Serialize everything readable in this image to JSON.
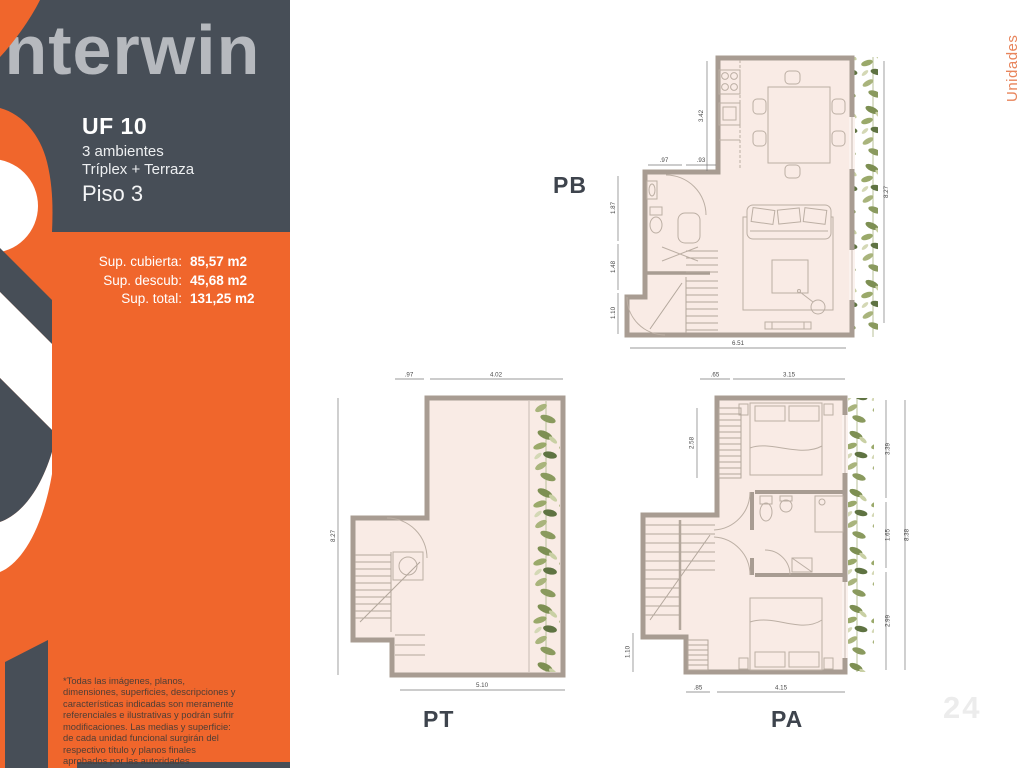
{
  "brand": {
    "logo": "interwin"
  },
  "side_tab": "Unidades",
  "watermark": "24",
  "unit": {
    "code": "UF 10",
    "rooms": "3 ambientes",
    "type": "Tríplex + Terraza",
    "floor": "Piso 3"
  },
  "surfaces": {
    "rows": [
      {
        "label": "Sup. cubierta:",
        "value": "85,57 m2"
      },
      {
        "label": "Sup. descub:",
        "value": "45,68 m2"
      },
      {
        "label": "Sup. total:",
        "value": "131,25 m2"
      }
    ]
  },
  "disclaimer": "*Todas las imágenes, planos, dimensiones, superficies, descripciones y características indicadas son meramente referenciales e ilustrativas y podrán sufrir modificaciones. Las medias y superficie: de cada unidad funcional surgirán del respectivo título y planos finales aprobados por las autoridades competentes.",
  "plans": {
    "pb": {
      "label": "PB",
      "dims": [
        ".97",
        ".93",
        "3.42",
        "1.87",
        "1.48",
        "1.10",
        "8.27",
        "6.51"
      ]
    },
    "pt": {
      "label": "PT",
      "dims": [
        ".97",
        "4.02",
        "8.27",
        "5.10"
      ]
    },
    "pa": {
      "label": "PA",
      "dims": [
        ".65",
        "3.15",
        "2.58",
        "1.10",
        "3.39",
        "1.65",
        "2.99",
        "8.38",
        ".85",
        "4.15"
      ]
    }
  },
  "colors": {
    "orange": "#F0662C",
    "dark_slate": "#474E57",
    "logo_gray": "#B6B9BE",
    "plan_fill": "#F9EBE5",
    "wall": "#A89C92",
    "plant_green": "#7D8F52",
    "accent_tab": "#E8855C"
  }
}
